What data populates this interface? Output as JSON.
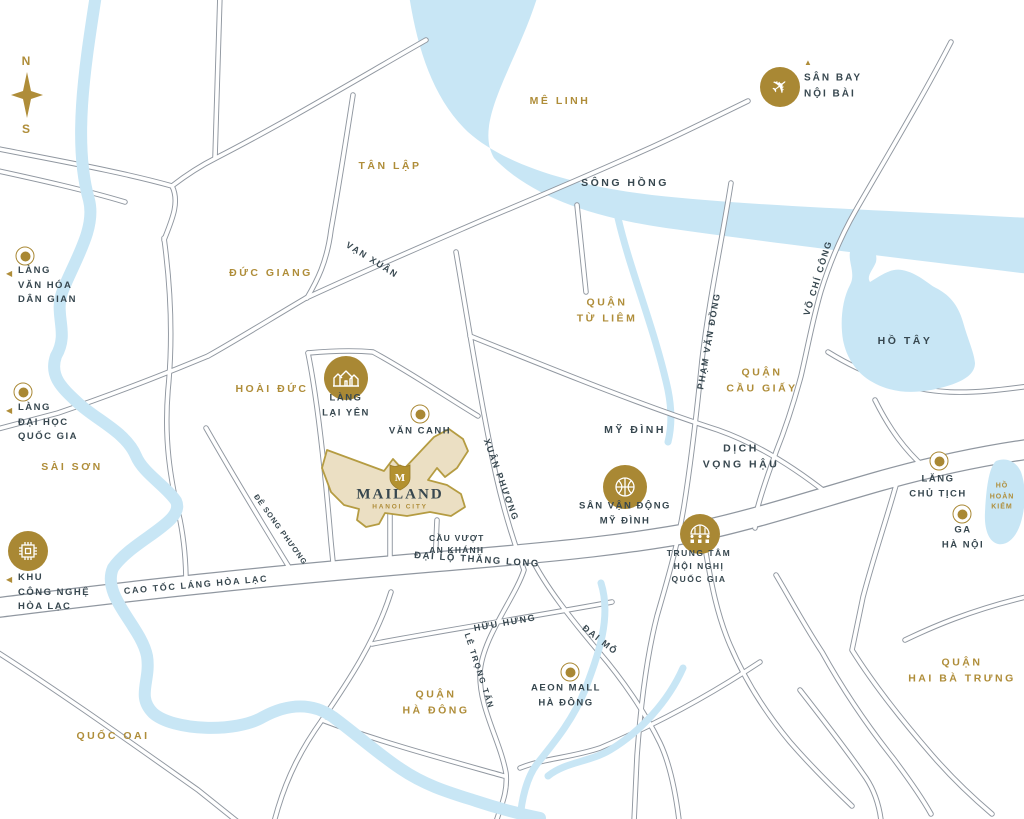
{
  "colors": {
    "gold": "#AF8D39",
    "navy": "#37474F",
    "water": "#C8E6F5",
    "road_casing": "#9097A0",
    "project_fill": "#EBDFC3",
    "project_border": "#B59C42"
  },
  "compass": {
    "north": "N",
    "south": "S"
  },
  "project": {
    "name": "MAILAND",
    "subtitle": "HANOI CITY",
    "monogram": "M"
  },
  "areas": {
    "me_linh": "MÊ LINH",
    "tan_lap": "TÂN LẬP",
    "duc_giang": "ĐỨC GIANG",
    "quan_tu_liem": "QUẬN\nTỪ LIÊM",
    "quan_cau_giay": "QUẬN\nCẦU GIẤY",
    "hoai_duc": "HOÀI ĐỨC",
    "sai_son": "SÀI SƠN",
    "my_dinh": "MỸ ĐÌNH",
    "dich_vong_hau": "DỊCH\nVỌNG HẬU",
    "quan_ha_dong": "QUẬN\nHÀ ĐÔNG",
    "quoc_oai": "QUỐC OAI",
    "quan_hai_ba_trung": "QUẬN\nHAI BÀ TRƯNG"
  },
  "water_labels": {
    "song_hong": "SÔNG HỒNG",
    "ho_tay": "HỒ TÂY",
    "ho_hoan_kiem": "HỒ\nHOÀN\nKIẾM"
  },
  "road_labels": {
    "van_xuan": "VẠN XUÂN",
    "vo_chi_cong": "VÕ CHÍ CÔNG",
    "pham_van_dong": "PHẠM VĂN ĐỒNG",
    "xuan_phuong": "XUÂN PHƯƠNG",
    "de_song_phuong": "ĐÊ SONG PHƯƠNG",
    "dai_lo_thang_long": "ĐẠI LỘ THĂNG LONG",
    "cao_toc_lang_hoa_lac": "CAO TỐC LÁNG HÒA LẠC",
    "huu_hung": "HỮU HƯNG",
    "dai_mo": "ĐẠI MỖ",
    "le_trong_tan": "LÊ TRỌNG TẤN",
    "cau_vuot_an_khanh": "CẦU VƯỢT\nAN KHÁNH"
  },
  "pois": {
    "san_bay_noi_bai": {
      "label": "SÂN BAY\nNỘI BÀI",
      "icon": "airplane-icon",
      "marker": "▲"
    },
    "lang_van_hoa_dan_gian": {
      "label": "LÀNG\nVĂN HÓA\nDÂN GIAN",
      "icon": "ring-dot",
      "marker": "◀"
    },
    "lang_dai_hoc_quoc_gia": {
      "label": "LÀNG\nĐẠI HỌC\nQUỐC GIA",
      "icon": "ring-dot",
      "marker": "◀"
    },
    "khu_cong_nghe_hoa_lac": {
      "label": "KHU\nCÔNG NGHỆ\nHÒA LẠC",
      "icon": "chip-icon",
      "marker": "◀"
    },
    "lang_lai_yen": {
      "label": "LÀNG\nLẠI YÊN",
      "icon": "village-icon"
    },
    "van_canh": {
      "label": "VĂN CANH",
      "icon": "ring-dot"
    },
    "san_van_dong_my_dinh": {
      "label": "SÂN VẬN ĐỘNG\nMỸ ĐÌNH",
      "icon": "stadium-icon"
    },
    "trung_tam_hoi_nghi_quoc_gia": {
      "label": "TRUNG TÂM\nHỘI NGHỊ\nQUỐC GIA",
      "icon": "convention-icon"
    },
    "lang_chu_tich": {
      "label": "LĂNG\nCHỦ TỊCH",
      "icon": "ring-dot"
    },
    "ga_ha_noi": {
      "label": "GA\nHÀ NỘI",
      "icon": "ring-dot"
    },
    "aeon_mall_ha_dong": {
      "label": "AEON MALL\nHÀ ĐÔNG",
      "icon": "ring-dot"
    }
  }
}
